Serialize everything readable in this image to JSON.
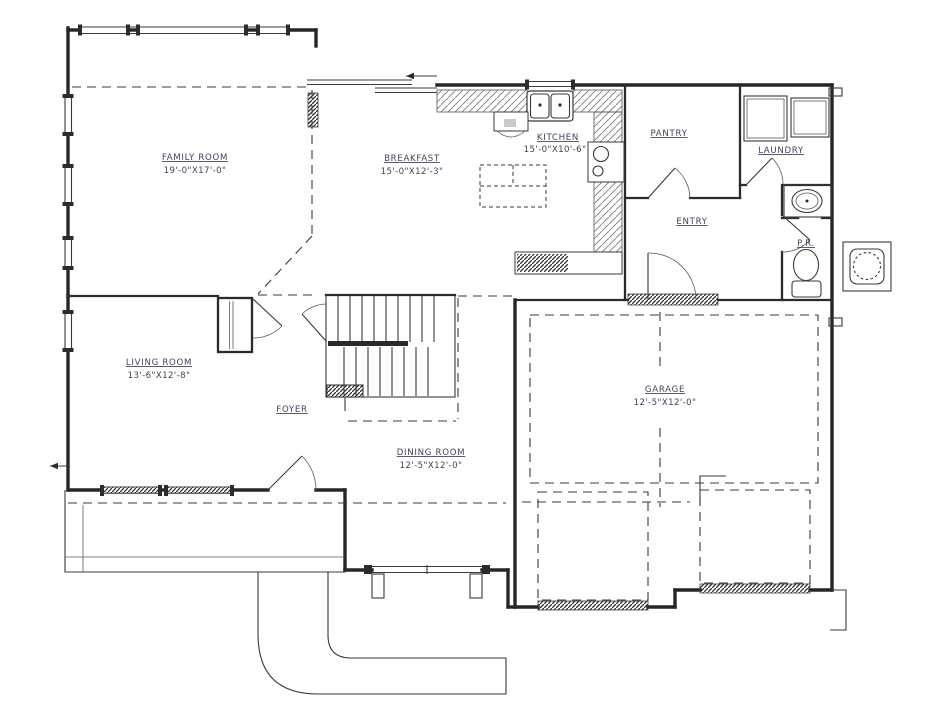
{
  "colors": {
    "line": "#262626",
    "text": "#42425a",
    "paper": "#ffffff"
  },
  "rooms": {
    "family_room": {
      "name": "FAMILY ROOM",
      "dims": "19'-0\"X17'-0\""
    },
    "breakfast": {
      "name": "BREAKFAST",
      "dims": "15'-0\"X12'-3\""
    },
    "kitchen": {
      "name": "KITCHEN",
      "dims": "15'-0\"X10'-6\""
    },
    "pantry": {
      "name": "PANTRY"
    },
    "laundry": {
      "name": "LAUNDRY"
    },
    "entry": {
      "name": "ENTRY"
    },
    "powder_room": {
      "name": "P.R."
    },
    "living_room": {
      "name": "LIVING ROOM",
      "dims": "13'-6\"X12'-8\""
    },
    "foyer": {
      "name": "FOYER"
    },
    "dining_room": {
      "name": "DINING ROOM",
      "dims": "12'-5\"X12'-0\""
    },
    "garage": {
      "name": "GARAGE",
      "dims": "12'-5\"X12'-0\""
    }
  }
}
